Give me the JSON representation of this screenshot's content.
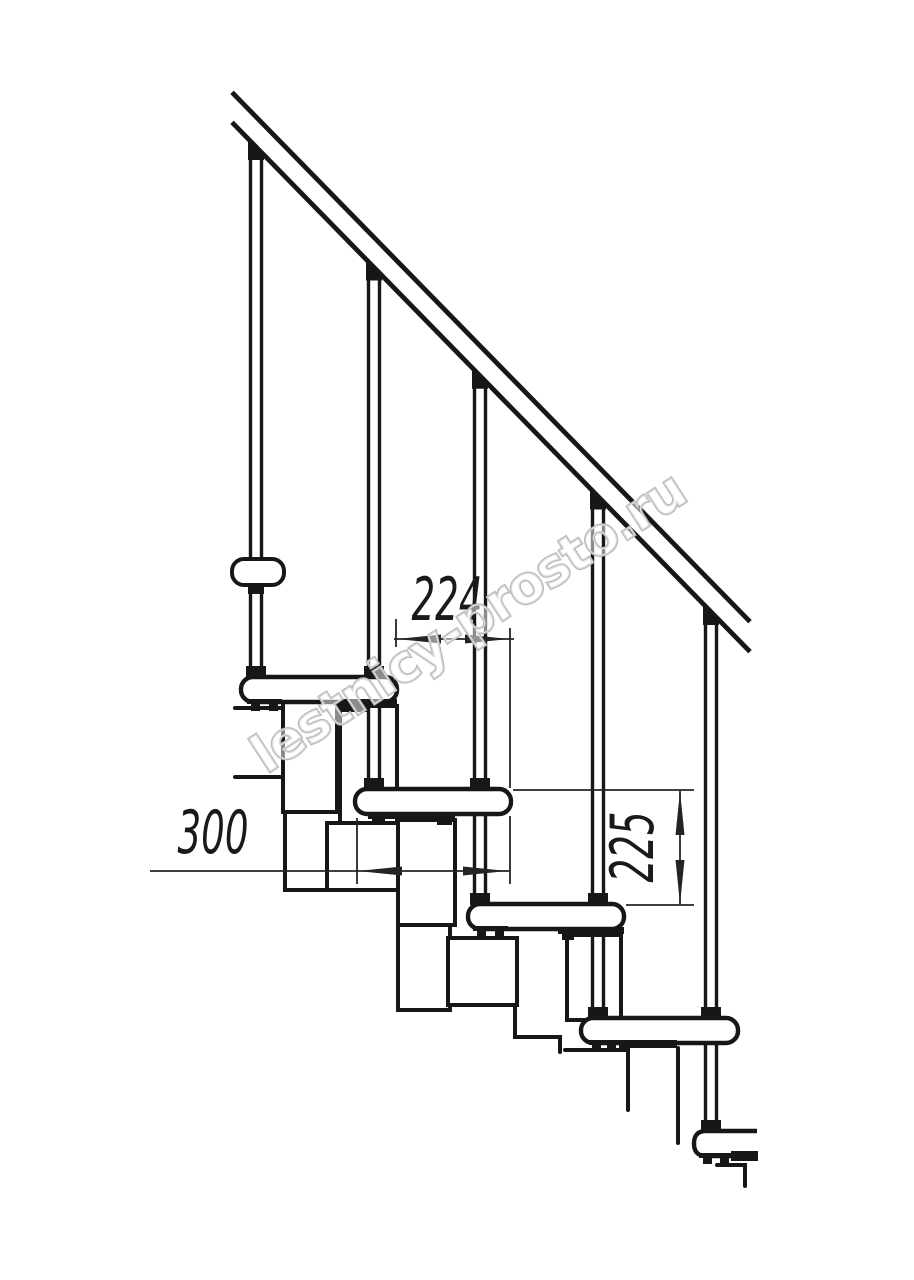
{
  "meta": {
    "title": "Modular staircase side-view technical drawing"
  },
  "canvas": {
    "width": 914,
    "height": 1280,
    "background": "#ffffff",
    "ink": "#171717",
    "dim_ink": "#242424",
    "watermark_ink": "#b9b9b9"
  },
  "watermark": {
    "text": "lestnicy-prosto.ru",
    "transform": "translate(478,637) rotate(-33)"
  },
  "dimensions": {
    "going": {
      "label": "224",
      "value_mm": 224,
      "transform": "translate(447,620) scale(0.62,1)"
    },
    "depth": {
      "label": "300",
      "value_mm": 300,
      "transform": "translate(213,853) scale(0.62,1)"
    },
    "rise": {
      "label": "225",
      "value_mm": 225,
      "transform": "translate(653,847) rotate(-90) scale(0.62,1)"
    }
  },
  "drawing": {
    "rail": {
      "upper": {
        "x1": 232,
        "y1": 92.3,
        "x2": 750,
        "y2": 621.7
      },
      "lower": {
        "x1": 232,
        "y1": 122.3,
        "x2": 750,
        "y2": 651.7
      }
    },
    "balusters": [
      {
        "n": "baluster-1",
        "xa": 250.5,
        "xb": 261.5,
        "y1": 156,
        "y2": 678,
        "wedge": "248,138.3 264,154.9 264,160 248,160"
      },
      {
        "n": "baluster-2",
        "xa": 368.5,
        "xb": 379.5,
        "y1": 278,
        "y2": 790,
        "wedge": "366,258.9 382,275.5 382,280.5 366,280.5"
      },
      {
        "n": "baluster-3",
        "xa": 474.5,
        "xb": 485.5,
        "y1": 386,
        "y2": 905,
        "wedge": "472,367.2 488,383.8 488,388.8 472,388.8"
      },
      {
        "n": "baluster-4",
        "xa": 592.5,
        "xb": 603.5,
        "y1": 507,
        "y2": 1019,
        "wedge": "590,487.8 606,504.4 606,509.5 590,509.5"
      },
      {
        "n": "baluster-5",
        "xa": 705.5,
        "xb": 716.5,
        "y1": 622,
        "y2": 1132,
        "wedge": "703,603.3 719,619.9 719,625 703,625"
      }
    ],
    "wall_bracket": {
      "x": 232,
      "y": 559,
      "w": 52,
      "h": 26,
      "rx": 12
    },
    "treads": [
      {
        "n": "tread-1",
        "x": 241,
        "y": 677,
        "w": 156,
        "h": 25
      },
      {
        "n": "tread-2",
        "x": 355,
        "y": 789,
        "w": 156,
        "h": 25
      },
      {
        "n": "tread-3",
        "x": 468,
        "y": 904,
        "w": 156,
        "h": 25
      },
      {
        "n": "tread-4",
        "x": 581,
        "y": 1018,
        "w": 157,
        "h": 25
      },
      {
        "n": "tread-5",
        "d": "M757,1131 L706,1131 Q694,1131 694,1143.5 Q694,1156 706,1156 L757,1156"
      }
    ],
    "white_rects": [
      {
        "n": "module-box-front-1",
        "x": 340,
        "y": 706,
        "w": 57,
        "h": 117
      },
      {
        "n": "module-box-rear-1",
        "x": 283,
        "y": 702,
        "w": 54,
        "h": 110
      },
      {
        "n": "module-box-rear-2",
        "x": 327,
        "y": 823,
        "w": 76,
        "h": 67
      },
      {
        "n": "module-box-front-2",
        "x": 398,
        "y": 820,
        "w": 57,
        "h": 105
      },
      {
        "n": "module-box-front-2b",
        "x": 398,
        "y": 925,
        "w": 52,
        "h": 85
      },
      {
        "n": "module-box-rear-3",
        "x": 448,
        "y": 938,
        "w": 69,
        "h": 67
      },
      {
        "n": "module-box-front-3",
        "x": 567,
        "y": 935,
        "w": 54,
        "h": 85
      }
    ],
    "lines": [
      {
        "n": "module-stub-line",
        "d": "M235,708 H283"
      },
      {
        "n": "module-stub-line",
        "d": "M235,777 H283"
      },
      {
        "n": "module-step-line",
        "d": "M285,812 V890 H327"
      },
      {
        "n": "module-step-line",
        "d": "M515,1005 V1037 H560 V1052"
      },
      {
        "n": "module-partial-line",
        "d": "M565,1050 H628 V1110"
      },
      {
        "n": "module-partial-line",
        "d": "M678,1048 V1143"
      },
      {
        "n": "module-partial-line",
        "d": "M717,1165 H745 V1186"
      }
    ],
    "black_rects": [
      {
        "n": "tread-1-rear-bracket",
        "x": 247,
        "y": 699,
        "w": 35,
        "h": 5
      },
      {
        "n": "tread-1-rear-foot",
        "x": 251,
        "y": 704,
        "w": 9,
        "h": 7
      },
      {
        "n": "tread-1-rear-foot",
        "x": 269,
        "y": 704,
        "w": 9,
        "h": 7
      },
      {
        "n": "tread-1-front-bracket",
        "x": 340,
        "y": 699,
        "w": 57,
        "h": 8
      },
      {
        "n": "tread-1-front-lip",
        "x": 340,
        "y": 707,
        "w": 27,
        "h": 5
      },
      {
        "n": "tread-2-bracket",
        "x": 368,
        "y": 812,
        "w": 87,
        "h": 7
      },
      {
        "n": "tread-2-foot",
        "x": 372,
        "y": 819,
        "w": 13,
        "h": 6
      },
      {
        "n": "tread-2-foot",
        "x": 437,
        "y": 819,
        "w": 15,
        "h": 6
      },
      {
        "n": "tread-3-rear-bracket",
        "x": 473,
        "y": 926,
        "w": 35,
        "h": 5
      },
      {
        "n": "tread-3-rear-foot",
        "x": 477,
        "y": 931,
        "w": 9,
        "h": 7
      },
      {
        "n": "tread-3-rear-foot",
        "x": 495,
        "y": 931,
        "w": 9,
        "h": 7
      },
      {
        "n": "tread-3-front-bracket",
        "x": 558,
        "y": 927,
        "w": 66,
        "h": 7
      },
      {
        "n": "tread-3-front-foot",
        "x": 562,
        "y": 934,
        "w": 12,
        "h": 6
      },
      {
        "n": "tread-4-rear-bracket",
        "x": 589,
        "y": 1040,
        "w": 32,
        "h": 5
      },
      {
        "n": "tread-4-rear-foot",
        "x": 592,
        "y": 1045,
        "w": 9,
        "h": 6
      },
      {
        "n": "tread-4-rear-foot",
        "x": 607,
        "y": 1045,
        "w": 9,
        "h": 6
      },
      {
        "n": "tread-4-front-bracket",
        "x": 619,
        "y": 1040,
        "w": 58,
        "h": 8
      },
      {
        "n": "tread-5-rear-bracket",
        "x": 699,
        "y": 1153,
        "w": 35,
        "h": 5
      },
      {
        "n": "tread-5-rear-foot",
        "x": 703,
        "y": 1158,
        "w": 9,
        "h": 6
      },
      {
        "n": "tread-5-rear-foot",
        "x": 720,
        "y": 1158,
        "w": 9,
        "h": 6
      },
      {
        "n": "tread-5-front-bracket",
        "x": 731,
        "y": 1151,
        "w": 27,
        "h": 10
      },
      {
        "n": "wall-bracket-foot",
        "x": 248,
        "y": 586,
        "w": 16,
        "h": 8
      }
    ],
    "collars": [
      {
        "n": "baluster-1-collar",
        "x": 246,
        "y": 666
      },
      {
        "n": "baluster-2-collar",
        "x": 364,
        "y": 666
      },
      {
        "n": "baluster-2-collar",
        "x": 364,
        "y": 778
      },
      {
        "n": "baluster-3-collar",
        "x": 470,
        "y": 778
      },
      {
        "n": "baluster-3-collar",
        "x": 470,
        "y": 893
      },
      {
        "n": "baluster-4-collar",
        "x": 588,
        "y": 893
      },
      {
        "n": "baluster-4-collar",
        "x": 588,
        "y": 1007
      },
      {
        "n": "baluster-5-collar",
        "x": 701,
        "y": 1007
      },
      {
        "n": "baluster-5-collar",
        "x": 701,
        "y": 1120
      }
    ],
    "dim_lines": [
      {
        "n": "dim-224-extension",
        "d": "M396,619 V647"
      },
      {
        "n": "dim-224-extension",
        "d": "M510,628 V788"
      },
      {
        "n": "dim-224-line",
        "d": "M394,639 H514"
      },
      {
        "n": "dim-300-extension",
        "d": "M357,818 V884"
      },
      {
        "n": "dim-300-extension",
        "d": "M510,816 V884"
      },
      {
        "n": "dim-300-line",
        "d": "M150,871 H509"
      },
      {
        "n": "dim-225-extension",
        "d": "M513,790 H694"
      },
      {
        "n": "dim-225-extension",
        "d": "M626,905 H694"
      },
      {
        "n": "dim-225-line",
        "d": "M680,790 V905"
      }
    ],
    "dim_arrows": [
      {
        "n": "dim-224-arrow-left",
        "pts": "397,639 441,634.5 441,643.5"
      },
      {
        "n": "dim-224-arrow-right",
        "pts": "509,639 465,634.5 465,643.5"
      },
      {
        "n": "dim-300-arrow-left",
        "pts": "358,871 402,866.5 402,875.5"
      },
      {
        "n": "dim-300-arrow-right",
        "pts": "507,871 463,866.5 463,875.5"
      },
      {
        "n": "dim-225-arrow-up",
        "pts": "680,791 675.5,835 684.5,835"
      },
      {
        "n": "dim-225-arrow-down",
        "pts": "680,904 675.5,860 684.5,860"
      }
    ]
  }
}
